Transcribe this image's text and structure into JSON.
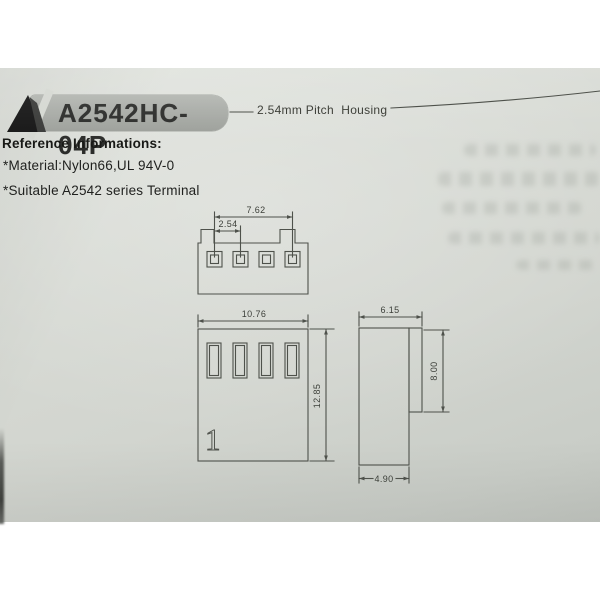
{
  "header": {
    "part_number": "A2542HC-04P",
    "subtitle": "2.54mm Pitch  Housing",
    "logo_icon": "black-triangle-logo"
  },
  "reference": {
    "heading": "Reference Informations:",
    "items": [
      "*Material:Nylon66,UL 94V-0",
      "*Suitable A2542 series Terminal"
    ]
  },
  "drawing": {
    "top_view": {
      "total_width": "7.62",
      "pitch": "2.54"
    },
    "front_view": {
      "width": "10.76",
      "height": "12.85",
      "pin_marking": "1"
    },
    "side_view": {
      "top_width": "6.15",
      "depth": "8.00",
      "bottom_width": "4.90"
    }
  },
  "colors": {
    "paper": "#d5d8d2",
    "line": "#4e514b",
    "badge_fill": "#a9aca7",
    "ink": "#1f201e"
  }
}
